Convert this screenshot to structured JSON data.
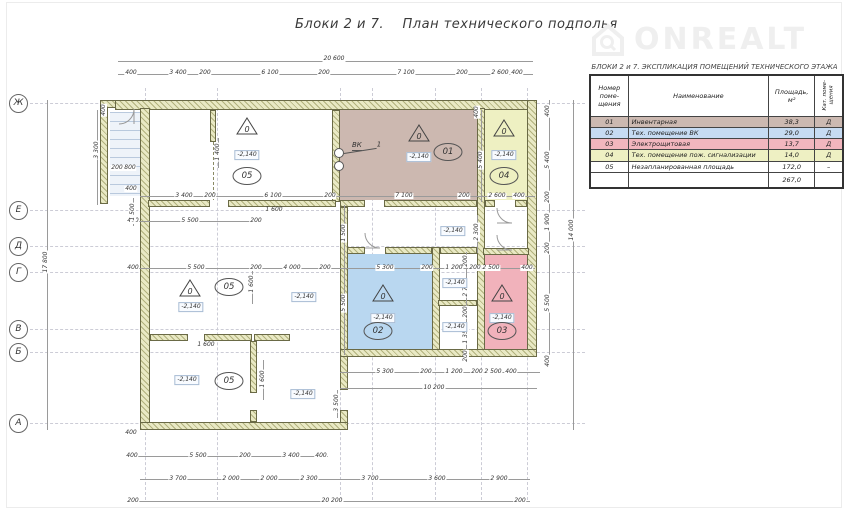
{
  "title": "Блоки 2 и 7.    План технического подполья",
  "watermark": {
    "brand": "ONREALT",
    "icon": "house-search-icon"
  },
  "table": {
    "title": "БЛОКИ 2 и 7.  ЭКСПЛИКАЦИЯ ПОМЕЩЕНИЙ ТЕХНИЧЕСКОГО ЭТАЖА",
    "headers": {
      "number": "Номер\nпоме-\nщения",
      "name": "Наименование",
      "area": "Площадь,\nм²",
      "category": "Кат. поме-\nщения"
    },
    "rows": [
      {
        "number": "01",
        "name": "Инвентарная",
        "area": "38,3",
        "category": "Д",
        "color": "#ccb9b1"
      },
      {
        "number": "02",
        "name": "Тех. помещение ВК",
        "area": "29,0",
        "category": "Д",
        "color": "#c6dbf2"
      },
      {
        "number": "03",
        "name": "Электрощитовая",
        "area": "13,7",
        "category": "Д",
        "color": "#f2b6be"
      },
      {
        "number": "04",
        "name": "Тех. помещение пож. сигнализации",
        "area": "14,0",
        "category": "Д",
        "color": "#eef0c3"
      },
      {
        "number": "05",
        "name": "Незапланированная площадь",
        "area": "172,0",
        "category": "–",
        "color": "#ffffff"
      }
    ],
    "total": "267,0"
  },
  "plan": {
    "elevation_value": "-2,140",
    "triangle_text": "0",
    "vk_label": "ВК",
    "vk_ref": "1",
    "axes": [
      {
        "label": "Ж",
        "y": 103
      },
      {
        "label": "Е",
        "y": 210
      },
      {
        "label": "Д",
        "y": 246
      },
      {
        "label": "Г",
        "y": 272
      },
      {
        "label": "В",
        "y": 329
      },
      {
        "label": "Б",
        "y": 352
      },
      {
        "label": "А",
        "y": 423
      }
    ],
    "grid_x": [
      145,
      217,
      340,
      372,
      435,
      481,
      527
    ],
    "rooms": [
      {
        "id": "01",
        "x": 340,
        "y": 110,
        "w": 137,
        "h": 90,
        "color": "#ccb8b0"
      },
      {
        "id": "04",
        "x": 485,
        "y": 110,
        "w": 42,
        "h": 90,
        "color": "#eef0c2"
      },
      {
        "id": "02",
        "x": 348,
        "y": 254,
        "w": 84,
        "h": 95,
        "color": "#b9d7f0"
      },
      {
        "id": "03",
        "x": 485,
        "y": 255,
        "w": 42,
        "h": 94,
        "color": "#f1b2bb"
      }
    ],
    "triangles": [
      [
        247,
        128
      ],
      [
        419,
        135
      ],
      [
        504,
        130
      ],
      [
        383,
        295
      ],
      [
        502,
        295
      ],
      [
        190,
        290
      ]
    ],
    "elevation_marks": [
      [
        247,
        155
      ],
      [
        419,
        157
      ],
      [
        504,
        155
      ],
      [
        383,
        318
      ],
      [
        502,
        318
      ],
      [
        191,
        307
      ],
      [
        187,
        380
      ],
      [
        304,
        297
      ],
      [
        303,
        394
      ],
      [
        453,
        231
      ],
      [
        455,
        283
      ],
      [
        455,
        327
      ]
    ],
    "ovals": [
      [
        "05",
        247,
        176
      ],
      [
        "01",
        448,
        152
      ],
      [
        "04",
        504,
        176
      ],
      [
        "02",
        378,
        331
      ],
      [
        "03",
        502,
        331
      ],
      [
        "05",
        229,
        287
      ],
      [
        "05",
        229,
        381
      ]
    ],
    "doors": [
      {
        "x": 118,
        "y": 108,
        "r": 0
      },
      {
        "x": 362,
        "y": 230,
        "r": 90
      },
      {
        "x": 494,
        "y": 205,
        "r": 90
      },
      {
        "x": 494,
        "y": 232,
        "r": 90
      }
    ],
    "lines_h": [
      [
        118,
        61,
        415
      ],
      [
        118,
        74,
        415
      ],
      [
        140,
        196,
        395
      ],
      [
        128,
        221,
        130
      ],
      [
        128,
        268,
        407
      ],
      [
        340,
        372,
        200
      ],
      [
        340,
        388,
        197
      ],
      [
        128,
        456,
        200
      ],
      [
        140,
        479,
        390
      ],
      [
        128,
        501,
        402
      ]
    ],
    "lines_v": [
      [
        549,
        100,
        265
      ],
      [
        573,
        100,
        330
      ],
      [
        47,
        100,
        330
      ],
      [
        97,
        110,
        95
      ],
      [
        344,
        205,
        150
      ],
      [
        466,
        252,
        110
      ],
      [
        481,
        110,
        92
      ],
      [
        218,
        138,
        30
      ],
      [
        133,
        198,
        28
      ],
      [
        252,
        266,
        38
      ],
      [
        263,
        360,
        40
      ],
      [
        337,
        390,
        28
      ],
      [
        477,
        215,
        38
      ]
    ],
    "dims": [
      {
        "t": "20 600",
        "x": 334,
        "y": 59
      },
      {
        "t": "400",
        "x": 131,
        "y": 73
      },
      {
        "t": "3 400",
        "x": 178,
        "y": 73
      },
      {
        "t": "200",
        "x": 205,
        "y": 73
      },
      {
        "t": "6 100",
        "x": 270,
        "y": 73
      },
      {
        "t": "200",
        "x": 324,
        "y": 73
      },
      {
        "t": "7 100",
        "x": 406,
        "y": 73
      },
      {
        "t": "200",
        "x": 462,
        "y": 73
      },
      {
        "t": "2 600",
        "x": 500,
        "y": 73
      },
      {
        "t": "400",
        "x": 517,
        "y": 73
      },
      {
        "t": "3 400",
        "x": 184,
        "y": 196
      },
      {
        "t": "200",
        "x": 210,
        "y": 196
      },
      {
        "t": "6 100",
        "x": 273,
        "y": 196
      },
      {
        "t": "200",
        "x": 330,
        "y": 196
      },
      {
        "t": "7 100",
        "x": 404,
        "y": 196
      },
      {
        "t": "200",
        "x": 464,
        "y": 196
      },
      {
        "t": "2 600",
        "x": 497,
        "y": 196
      },
      {
        "t": "400",
        "x": 519,
        "y": 196
      },
      {
        "t": "400",
        "x": 133,
        "y": 221
      },
      {
        "t": "5 500",
        "x": 190,
        "y": 221
      },
      {
        "t": "200",
        "x": 256,
        "y": 221
      },
      {
        "t": "1 600",
        "x": 274,
        "y": 210
      },
      {
        "t": "400",
        "x": 133,
        "y": 268
      },
      {
        "t": "5 500",
        "x": 196,
        "y": 268
      },
      {
        "t": "200",
        "x": 256,
        "y": 268
      },
      {
        "t": "4 000",
        "x": 292,
        "y": 268
      },
      {
        "t": "200",
        "x": 325,
        "y": 268
      },
      {
        "t": "5 300",
        "x": 385,
        "y": 268
      },
      {
        "t": "200",
        "x": 427,
        "y": 268
      },
      {
        "t": "1 200",
        "x": 454,
        "y": 268
      },
      {
        "t": "200",
        "x": 475,
        "y": 268
      },
      {
        "t": "2 500",
        "x": 491,
        "y": 268
      },
      {
        "t": "400",
        "x": 527,
        "y": 268
      },
      {
        "t": "5 300",
        "x": 385,
        "y": 372
      },
      {
        "t": "200",
        "x": 426,
        "y": 372
      },
      {
        "t": "1 200",
        "x": 454,
        "y": 372
      },
      {
        "t": "200",
        "x": 477,
        "y": 372
      },
      {
        "t": "2 500",
        "x": 493,
        "y": 372
      },
      {
        "t": "400",
        "x": 511,
        "y": 372
      },
      {
        "t": "10 200",
        "x": 434,
        "y": 388
      },
      {
        "t": "1 600",
        "x": 206,
        "y": 345
      },
      {
        "t": "400",
        "x": 132,
        "y": 456
      },
      {
        "t": "5 500",
        "x": 198,
        "y": 456
      },
      {
        "t": "200",
        "x": 245,
        "y": 456
      },
      {
        "t": "3 400",
        "x": 291,
        "y": 456
      },
      {
        "t": "400",
        "x": 321,
        "y": 456
      },
      {
        "t": "3 700",
        "x": 178,
        "y": 479
      },
      {
        "t": "2 000",
        "x": 231,
        "y": 479
      },
      {
        "t": "2 000",
        "x": 269,
        "y": 479
      },
      {
        "t": "2 300",
        "x": 309,
        "y": 479
      },
      {
        "t": "3 700",
        "x": 370,
        "y": 479
      },
      {
        "t": "3 600",
        "x": 437,
        "y": 479
      },
      {
        "t": "2 900",
        "x": 499,
        "y": 479
      },
      {
        "t": "200",
        "x": 133,
        "y": 501
      },
      {
        "t": "20 200",
        "x": 332,
        "y": 501
      },
      {
        "t": "200",
        "x": 520,
        "y": 501
      },
      {
        "t": "400",
        "x": 548,
        "y": 111,
        "r": 1
      },
      {
        "t": "5 400",
        "x": 548,
        "y": 160,
        "r": 1
      },
      {
        "t": "200",
        "x": 548,
        "y": 197,
        "r": 1
      },
      {
        "t": "1 900",
        "x": 548,
        "y": 222,
        "r": 1
      },
      {
        "t": "200",
        "x": 548,
        "y": 248,
        "r": 1
      },
      {
        "t": "5 500",
        "x": 548,
        "y": 303,
        "r": 1
      },
      {
        "t": "400",
        "x": 548,
        "y": 361,
        "r": 1
      },
      {
        "t": "14 000",
        "x": 572,
        "y": 230,
        "r": 1
      },
      {
        "t": "400",
        "x": 477,
        "y": 112,
        "r": 1
      },
      {
        "t": "5 400",
        "x": 481,
        "y": 160,
        "r": 1
      },
      {
        "t": "2 300",
        "x": 477,
        "y": 232,
        "r": 1
      },
      {
        "t": "200",
        "x": 466,
        "y": 261,
        "r": 1
      },
      {
        "t": "2 700",
        "x": 466,
        "y": 288,
        "r": 1
      },
      {
        "t": "200",
        "x": 466,
        "y": 312,
        "r": 1
      },
      {
        "t": "1 350",
        "x": 466,
        "y": 335,
        "r": 1
      },
      {
        "t": "200",
        "x": 466,
        "y": 356,
        "r": 1
      },
      {
        "t": "5 500",
        "x": 344,
        "y": 303,
        "r": 1
      },
      {
        "t": "1 500",
        "x": 344,
        "y": 233,
        "r": 1
      },
      {
        "t": "1 600",
        "x": 252,
        "y": 284,
        "r": 1
      },
      {
        "t": "1 600",
        "x": 263,
        "y": 379,
        "r": 1
      },
      {
        "t": "3 500",
        "x": 337,
        "y": 403,
        "r": 1
      },
      {
        "t": "1 400",
        "x": 218,
        "y": 152,
        "r": 1
      },
      {
        "t": "1 500",
        "x": 133,
        "y": 212,
        "r": 1
      },
      {
        "t": "3 300",
        "x": 97,
        "y": 150,
        "r": 1
      },
      {
        "t": "400",
        "x": 104,
        "y": 110,
        "r": 1
      },
      {
        "t": "17 800",
        "x": 46,
        "y": 262,
        "r": 1
      },
      {
        "t": "200",
        "x": 117,
        "y": 168
      },
      {
        "t": "800",
        "x": 130,
        "y": 168
      },
      {
        "t": "400",
        "x": 131,
        "y": 189
      },
      {
        "t": "400",
        "x": 131,
        "y": 433
      }
    ]
  }
}
